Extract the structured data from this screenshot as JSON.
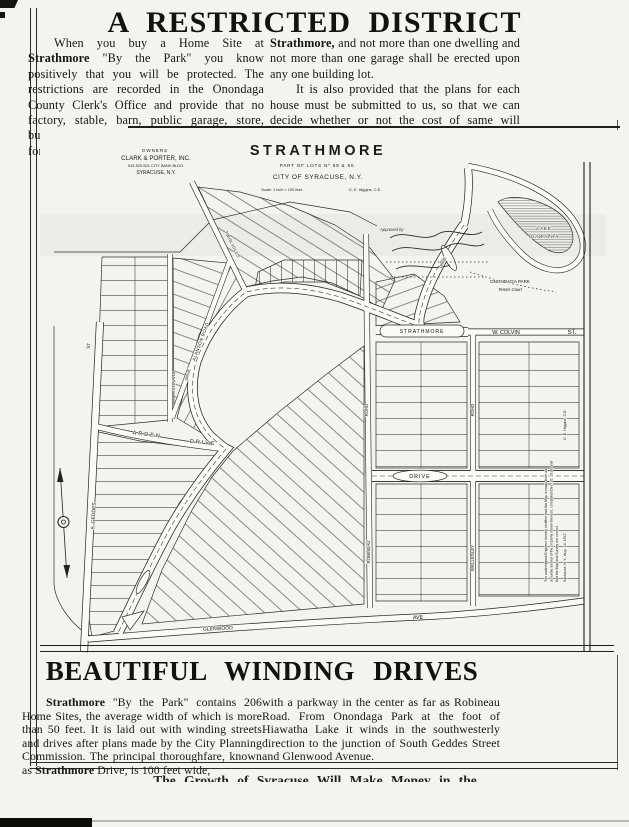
{
  "header": {
    "title": "A RESTRICTED DISTRICT"
  },
  "intro": {
    "left": [
      {
        "t": "When you buy a Home Site at "
      },
      {
        "t": "Strathmore",
        "b": 1
      },
      {
        "t": " \"By the Park\" you know positively that you will be protected.  The restrictions are recorded in the Onondaga County Clerk's Office and provide that no factory, stable, barn, public garage, store, business place, apartment house nor dwelling for more than one family shall be erected in"
      }
    ],
    "right_p1": [
      {
        "t": "Strathmore,",
        "b": 1
      },
      {
        "t": " and not more than one dwelling and not more than one garage shall be erected upon any one building lot."
      }
    ],
    "right_p2": "It is also provided that the plans for each house must be submitted to us, so that we can decide whether or not the cost of same will comply with the restrictions."
  },
  "map": {
    "labels": [
      {
        "id": "owners-heading",
        "text": "OWNERS",
        "x": 115,
        "y": 22,
        "size": 4.5,
        "ls": 1
      },
      {
        "id": "owners-name",
        "text": "CLARK & PORTER, INC.",
        "x": 116,
        "y": 30,
        "size": 6.2
      },
      {
        "id": "owners-address",
        "text": "519-520-521 CITY BANK BLDG.",
        "x": 116,
        "y": 37,
        "size": 3.9
      },
      {
        "id": "owners-city",
        "text": "SYRACUSE, N.Y.",
        "x": 116,
        "y": 44,
        "size": 5
      },
      {
        "id": "plat-title",
        "text": "STRATHMORE",
        "x": 278,
        "y": 25,
        "size": 14.5,
        "bold": 1,
        "ls": 3.5
      },
      {
        "id": "plat-subtitle",
        "text": "PART OF LOTS Nº 89 & 90.",
        "x": 278,
        "y": 37,
        "size": 4.6,
        "ls": 0.8
      },
      {
        "id": "plat-city",
        "text": "CITY OF SYRACUSE, N.Y.",
        "x": 278,
        "y": 49,
        "size": 6.4,
        "ls": 0.6
      },
      {
        "id": "plat-scale",
        "text": "Scale: 1 inch = 100 feet.",
        "x": 242,
        "y": 61,
        "size": 3.9
      },
      {
        "id": "plat-engineer",
        "text": "G. E. Higgins, C.E.",
        "x": 325,
        "y": 61,
        "size": 3.9
      },
      {
        "id": "street-st",
        "text": "ST",
        "x": 50,
        "y": 216,
        "rot": -86,
        "size": 4.5
      },
      {
        "id": "street-s-geddes",
        "text": "S. GEDDES",
        "x": 55,
        "y": 386,
        "rot": -87,
        "size": 5
      },
      {
        "id": "street-arden",
        "text": "ARDEN",
        "x": 107,
        "y": 306,
        "rot": 7,
        "size": 5.5,
        "ls": 2
      },
      {
        "id": "street-arden-drive",
        "text": "DRIVE",
        "x": 163,
        "y": 314,
        "rot": 6,
        "size": 5.5,
        "ls": 2
      },
      {
        "id": "street-stinard",
        "text": "STINARD",
        "x": 135,
        "y": 251,
        "rot": -90,
        "size": 4.4
      },
      {
        "id": "street-alanson",
        "text": "ALANSON ROAD",
        "x": 162,
        "y": 212,
        "rot": -70,
        "size": 4.4,
        "ls": 0.5
      },
      {
        "id": "street-twin-hills",
        "text": "TWIN HILLS",
        "x": 191,
        "y": 115,
        "rot": 63,
        "size": 4.4,
        "ls": 0.5
      },
      {
        "id": "street-strathmore-pill",
        "text": "STRATHMORE",
        "x": 382,
        "y": 203,
        "size": 5,
        "ls": 1
      },
      {
        "id": "street-w-colvin",
        "text": "W. COLVIN",
        "x": 466,
        "y": 204,
        "size": 5.4
      },
      {
        "id": "street-w-colvin-st",
        "text": "ST.",
        "x": 532,
        "y": 204,
        "size": 6.2
      },
      {
        "id": "street-robineau-road",
        "text": "ROAD",
        "x": 328,
        "y": 280,
        "rot": -90,
        "size": 4.4
      },
      {
        "id": "street-robineau",
        "text": "ROBINEAU",
        "x": 330,
        "y": 422,
        "rot": -90,
        "size": 4.4
      },
      {
        "id": "street-wellesley-road",
        "text": "ROAD",
        "x": 434,
        "y": 280,
        "rot": -90,
        "size": 4.4
      },
      {
        "id": "street-wellesley",
        "text": "WELLESLEY",
        "x": 434,
        "y": 428,
        "rot": -90,
        "size": 4.4
      },
      {
        "id": "street-central-drive",
        "text": "DRIVE",
        "x": 380,
        "y": 348,
        "size": 5.4,
        "ls": 1
      },
      {
        "id": "street-glenwood",
        "text": "GLENWOOD",
        "x": 178,
        "y": 500,
        "rot": -3,
        "size": 5
      },
      {
        "id": "street-glenwood-ave",
        "text": "AVE",
        "x": 378,
        "y": 489,
        "rot": -3,
        "size": 5.4
      },
      {
        "id": "street-drive-upper",
        "text": "DRIVE",
        "x": 404,
        "y": 133,
        "rot": -65,
        "size": 3.8
      },
      {
        "id": "street-drive-lower",
        "text": "DRIVE",
        "x": 149,
        "y": 245,
        "rot": -75,
        "size": 3.8
      },
      {
        "id": "lake-line1",
        "text": "LAKE",
        "x": 504,
        "y": 100,
        "size": 4.4,
        "italic": 1,
        "ls": 1
      },
      {
        "id": "lake-line2",
        "text": "HIAWATHA",
        "x": 504,
        "y": 108,
        "size": 4.4,
        "italic": 1,
        "ls": 1
      },
      {
        "id": "park-line1",
        "text": "ONONDAGA  PARK",
        "x": 470,
        "y": 153,
        "size": 4.6
      },
      {
        "id": "park-line2",
        "text": "Tennis Court",
        "x": 470,
        "y": 161,
        "size": 4.2,
        "italic": 1
      },
      {
        "id": "approved-by",
        "text": "Approved by",
        "x": 340,
        "y": 101,
        "size": 4.2,
        "italic": 1,
        "anchor": "start"
      },
      {
        "id": "cert-line1",
        "text": "The undersigned Engineer hereby certifies that this Map is made from an",
        "x": 507,
        "y": 452,
        "rot": -90,
        "size": 3.5,
        "anchor": "start"
      },
      {
        "id": "cert-line2",
        "text": "accurate survey of the property shown thereon, completed Dec. 16, 1916, and",
        "x": 512.5,
        "y": 452,
        "rot": -90,
        "size": 3.5,
        "anchor": "start"
      },
      {
        "id": "cert-line3",
        "text": "that the Map and Survey are correct.",
        "x": 518,
        "y": 452,
        "rot": -90,
        "size": 3.5,
        "anchor": "start"
      },
      {
        "id": "cert-date",
        "text": "Syracuse, N.Y., Aug. 14, 1917.",
        "x": 526,
        "y": 452,
        "rot": -90,
        "size": 3.7,
        "anchor": "start"
      },
      {
        "id": "cert-signature",
        "text": "C. E. Higgins, C.E.",
        "x": 526,
        "y": 310,
        "rot": -90,
        "size": 3.7,
        "anchor": "start"
      }
    ]
  },
  "lower": {
    "heading": "BEAUTIFUL WINDING DRIVES",
    "left": [
      {
        "t": "Strathmore",
        "b": 1
      },
      {
        "t": " \"By the Park\" contains 206 Home Sites, the average width of which is more than 50 feet.  It is laid out with winding streets and drives after plans made by the City Planning Commission.  The principal thoroughfare, known as "
      },
      {
        "t": "Strathmore",
        "b": 1
      },
      {
        "t": " Drive, is 100 feet wide,"
      }
    ],
    "right": "with a parkway in the center as far as Robineau Road. From Onondaga Park at the foot of Hiawatha Lake it winds in the southwesterly direction to the junction of South Geddes Street and Glenwood Avenue."
  },
  "footer": {
    "cutoff": "The Growth of Syracuse Will Make Money in the"
  }
}
